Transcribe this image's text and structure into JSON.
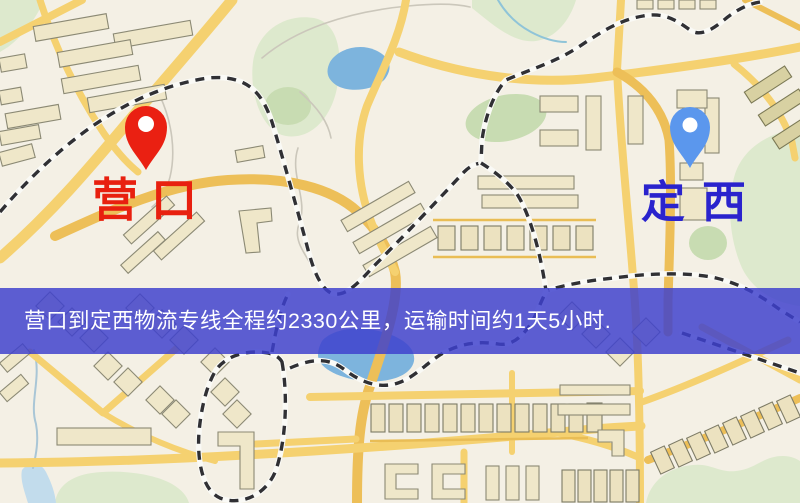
{
  "map": {
    "origin": {
      "label": "营口",
      "marker": "red-map-pin"
    },
    "destination": {
      "label": "定西",
      "marker": "blue-map-pin"
    },
    "banner": {
      "text": "营口到定西物流专线全程约2330公里，运输时间约1天5小时."
    },
    "route": {
      "distance_text": "约2330公里",
      "duration_text": "约1天5小时"
    },
    "colors": {
      "origin_pin": "#ea2012",
      "origin_label": "#e8200f",
      "destination_pin": "#5b97ed",
      "destination_label": "#2a23cd",
      "banner_bg": "rgba(62,64,205,0.84)",
      "banner_text": "#ffffff",
      "road": "#f5d170",
      "road_accent": "#edbf58",
      "water": "#7db4dd",
      "park": "#dde9cd",
      "building": "#efe7c9"
    }
  }
}
